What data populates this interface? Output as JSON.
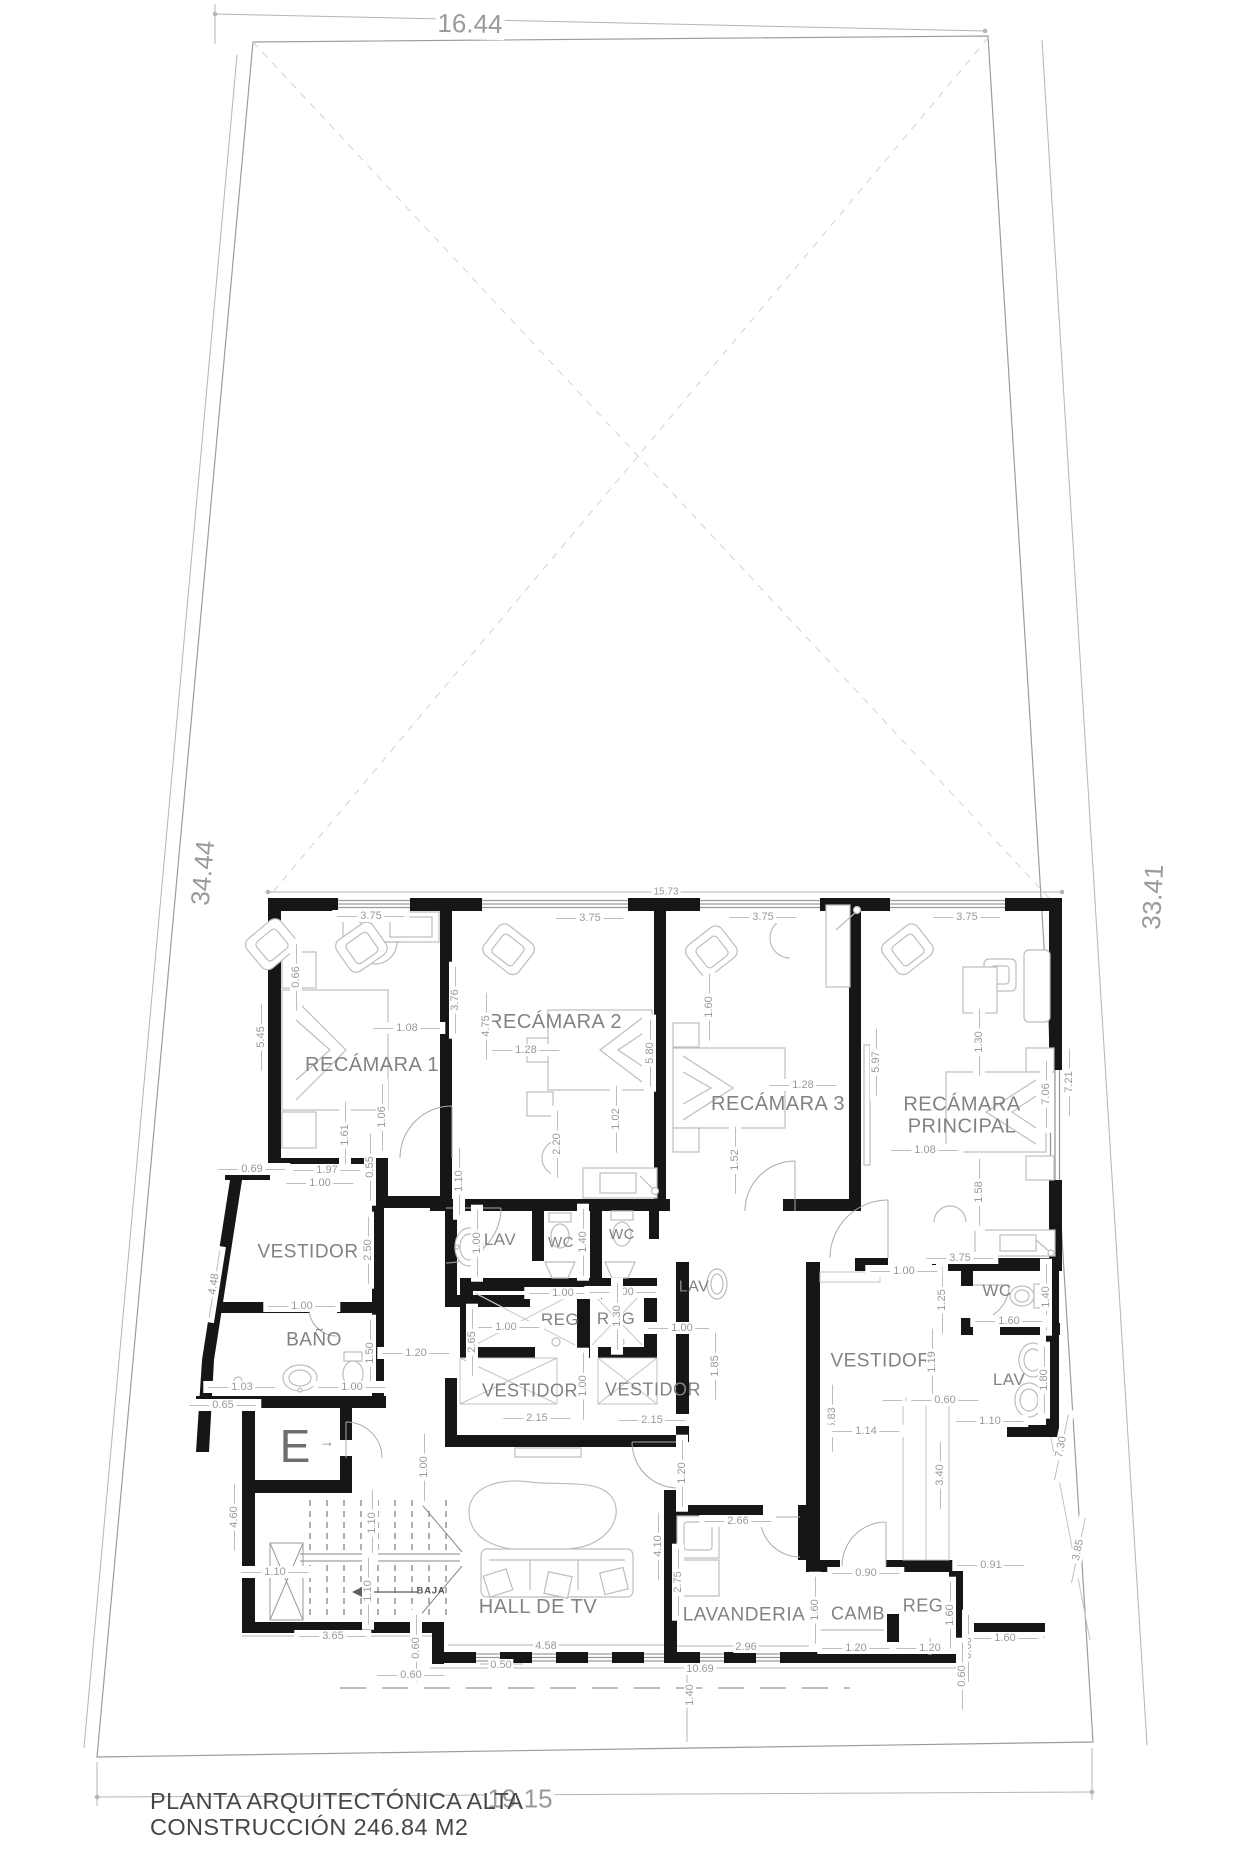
{
  "plan": {
    "title_line1": "PLANTA ARQUITECTÓNICA ALTA",
    "title_line2": "CONSTRUCCIÓN 246.84 M2",
    "elevator_label": "E",
    "elevator_arrow": "→",
    "stairs_direction": "BAJA",
    "site_dimensions": {
      "top": "16.44",
      "left": "34.44",
      "right": "33.41",
      "bottom": "19.15"
    },
    "rooms": [
      {
        "label": "RECÁMARA 1",
        "x": 372,
        "y": 1066,
        "fs": 20
      },
      {
        "label": "RECÁMARA 2",
        "x": 555,
        "y": 1023,
        "fs": 20
      },
      {
        "label": "RECÁMARA 3",
        "x": 778,
        "y": 1105,
        "fs": 20
      },
      {
        "label": "RECÁMARA PRINCIPAL",
        "x": 962,
        "y": 1116,
        "fs": 20,
        "w": 175
      },
      {
        "label": "VESTIDOR",
        "x": 308,
        "y": 1253,
        "fs": 19
      },
      {
        "label": "BAÑO",
        "x": 314,
        "y": 1341,
        "fs": 19
      },
      {
        "label": "LAV",
        "x": 500,
        "y": 1240,
        "fs": 17
      },
      {
        "label": "WC",
        "x": 561,
        "y": 1243,
        "fs": 15
      },
      {
        "label": "WC",
        "x": 622,
        "y": 1235,
        "fs": 15
      },
      {
        "label": "REG",
        "x": 560,
        "y": 1320,
        "fs": 17
      },
      {
        "label": "REG",
        "x": 616,
        "y": 1319,
        "fs": 17
      },
      {
        "label": "VESTIDOR",
        "x": 530,
        "y": 1391,
        "fs": 18
      },
      {
        "label": "VESTIDOR",
        "x": 653,
        "y": 1390,
        "fs": 18
      },
      {
        "label": "LAV",
        "x": 694,
        "y": 1287,
        "fs": 16
      },
      {
        "label": "VESTIDOR",
        "x": 881,
        "y": 1362,
        "fs": 19
      },
      {
        "label": "WC",
        "x": 997,
        "y": 1291,
        "fs": 17
      },
      {
        "label": "LAV",
        "x": 1009,
        "y": 1380,
        "fs": 17
      },
      {
        "label": "HALL DE TV",
        "x": 538,
        "y": 1608,
        "fs": 20
      },
      {
        "label": "LAVANDERIA",
        "x": 744,
        "y": 1616,
        "fs": 19
      },
      {
        "label": "CAMB",
        "x": 858,
        "y": 1614,
        "fs": 18
      },
      {
        "label": "REG",
        "x": 923,
        "y": 1606,
        "fs": 18
      }
    ],
    "dims": [
      {
        "t": "16.44",
        "x": 470,
        "y": 24,
        "r": 1,
        "fs": 26,
        "nd": 1
      },
      {
        "t": "34.44",
        "x": 203,
        "y": 873,
        "r": -85,
        "fs": 26,
        "nd": 1
      },
      {
        "t": "33.41",
        "x": 1153,
        "y": 897,
        "r": -87,
        "fs": 26,
        "nd": 1
      },
      {
        "t": "19.15",
        "x": 520,
        "y": 1799,
        "r": 0,
        "fs": 26,
        "nd": 1
      },
      {
        "t": "15.73",
        "x": 666,
        "y": 892,
        "r": 0,
        "fs": 10,
        "nd": 1
      },
      {
        "t": "3.75",
        "x": 371,
        "y": 916,
        "r": 0
      },
      {
        "t": "3.75",
        "x": 590,
        "y": 918,
        "r": 0
      },
      {
        "t": "3.75",
        "x": 763,
        "y": 917,
        "r": 0
      },
      {
        "t": "3.75",
        "x": 967,
        "y": 917,
        "r": 0
      },
      {
        "t": "5.45",
        "x": 261,
        "y": 1037,
        "r": -90
      },
      {
        "t": "0.66",
        "x": 296,
        "y": 977,
        "r": -90
      },
      {
        "t": "1.08",
        "x": 407,
        "y": 1028,
        "r": 0
      },
      {
        "t": "3.76",
        "x": 455,
        "y": 1000,
        "r": -90
      },
      {
        "t": "4.75",
        "x": 486,
        "y": 1026,
        "r": -90
      },
      {
        "t": "1.61",
        "x": 345,
        "y": 1135,
        "r": -90
      },
      {
        "t": "1.06",
        "x": 382,
        "y": 1117,
        "r": -90
      },
      {
        "t": "1.28",
        "x": 526,
        "y": 1050,
        "r": 0
      },
      {
        "t": "5.80",
        "x": 650,
        "y": 1053,
        "r": -90
      },
      {
        "t": "1.02",
        "x": 616,
        "y": 1119,
        "r": -90
      },
      {
        "t": "2.20",
        "x": 557,
        "y": 1144,
        "r": -90
      },
      {
        "t": "1.60",
        "x": 709,
        "y": 1007,
        "r": -90
      },
      {
        "t": "1.28",
        "x": 803,
        "y": 1085,
        "r": 0
      },
      {
        "t": "5.97",
        "x": 876,
        "y": 1062,
        "r": -90
      },
      {
        "t": "1.52",
        "x": 735,
        "y": 1160,
        "r": -90
      },
      {
        "t": "1.30",
        "x": 979,
        "y": 1042,
        "r": -90
      },
      {
        "t": "1.08",
        "x": 925,
        "y": 1150,
        "r": 0
      },
      {
        "t": "7.06",
        "x": 1046,
        "y": 1094,
        "r": -90
      },
      {
        "t": "7.21",
        "x": 1069,
        "y": 1082,
        "r": -90
      },
      {
        "t": "1.58",
        "x": 979,
        "y": 1192,
        "r": -90
      },
      {
        "t": "0.69",
        "x": 252,
        "y": 1169,
        "r": 0
      },
      {
        "t": "1.97",
        "x": 327,
        "y": 1170,
        "r": 0
      },
      {
        "t": "1.00",
        "x": 320,
        "y": 1183,
        "r": 0
      },
      {
        "t": "0.55",
        "x": 370,
        "y": 1167,
        "r": -90
      },
      {
        "t": "2.50",
        "x": 368,
        "y": 1250,
        "r": -90
      },
      {
        "t": "4.48",
        "x": 214,
        "y": 1284,
        "r": -81
      },
      {
        "t": "1.00",
        "x": 302,
        "y": 1306,
        "r": 0
      },
      {
        "t": "1.50",
        "x": 370,
        "y": 1353,
        "r": -90
      },
      {
        "t": "1.03",
        "x": 242,
        "y": 1387,
        "r": 0
      },
      {
        "t": "1.00",
        "x": 352,
        "y": 1387,
        "r": 0
      },
      {
        "t": "0.65",
        "x": 223,
        "y": 1405,
        "r": 0
      },
      {
        "t": "1.20",
        "x": 416,
        "y": 1353,
        "r": 0
      },
      {
        "t": "4.60",
        "x": 234,
        "y": 1517,
        "r": -90
      },
      {
        "t": "1.10",
        "x": 372,
        "y": 1523,
        "r": -90
      },
      {
        "t": "1.10",
        "x": 275,
        "y": 1572,
        "r": 0
      },
      {
        "t": "1.10",
        "x": 368,
        "y": 1591,
        "r": -90
      },
      {
        "t": "1.00",
        "x": 424,
        "y": 1467,
        "r": -90
      },
      {
        "t": "3.65",
        "x": 333,
        "y": 1636,
        "r": 0
      },
      {
        "t": "0.60",
        "x": 416,
        "y": 1648,
        "r": -90
      },
      {
        "t": "0.60",
        "x": 411,
        "y": 1675,
        "r": 0
      },
      {
        "t": "1.10",
        "x": 459,
        "y": 1181,
        "r": -90
      },
      {
        "t": "1.00",
        "x": 477,
        "y": 1243,
        "r": -90
      },
      {
        "t": "1.40",
        "x": 583,
        "y": 1242,
        "r": -90
      },
      {
        "t": "1.00",
        "x": 563,
        "y": 1293,
        "r": 0
      },
      {
        "t": "1.00",
        "x": 623,
        "y": 1292,
        "r": 0
      },
      {
        "t": "1.30",
        "x": 617,
        "y": 1316,
        "r": -90
      },
      {
        "t": "1.00",
        "x": 506,
        "y": 1327,
        "r": 0
      },
      {
        "t": "1.00",
        "x": 682,
        "y": 1328,
        "r": 0
      },
      {
        "t": "2.65",
        "x": 472,
        "y": 1342,
        "r": -90
      },
      {
        "t": "1.00",
        "x": 583,
        "y": 1386,
        "r": -90
      },
      {
        "t": "2.15",
        "x": 537,
        "y": 1418,
        "r": 0
      },
      {
        "t": "2.15",
        "x": 652,
        "y": 1420,
        "r": 0
      },
      {
        "t": "1.85",
        "x": 715,
        "y": 1366,
        "r": -90
      },
      {
        "t": "1.20",
        "x": 682,
        "y": 1473,
        "r": -90
      },
      {
        "t": "4.10",
        "x": 658,
        "y": 1546,
        "r": -90
      },
      {
        "t": "2.75",
        "x": 678,
        "y": 1582,
        "r": -90
      },
      {
        "t": "4.58",
        "x": 546,
        "y": 1646,
        "r": 0,
        "nd": 1
      },
      {
        "t": "0.50",
        "x": 501,
        "y": 1665,
        "r": 0,
        "nd": 1
      },
      {
        "t": "10.69",
        "x": 700,
        "y": 1669,
        "r": 0,
        "nd": 1
      },
      {
        "t": "1.40",
        "x": 690,
        "y": 1695,
        "r": -90,
        "nd": 1
      },
      {
        "t": "2.96",
        "x": 746,
        "y": 1647,
        "r": 0,
        "nd": 1
      },
      {
        "t": "2.66",
        "x": 738,
        "y": 1521,
        "r": 0
      },
      {
        "t": "1.60",
        "x": 815,
        "y": 1610,
        "r": -90
      },
      {
        "t": "0.90",
        "x": 866,
        "y": 1573,
        "r": 0
      },
      {
        "t": "1.20",
        "x": 856,
        "y": 1648,
        "r": 0
      },
      {
        "t": "1.20",
        "x": 930,
        "y": 1648,
        "r": 0
      },
      {
        "t": "1.60",
        "x": 950,
        "y": 1615,
        "r": -90
      },
      {
        "t": "0.91",
        "x": 991,
        "y": 1565,
        "r": 0
      },
      {
        "t": "1.60",
        "x": 1005,
        "y": 1638,
        "r": 0
      },
      {
        "t": "0.60",
        "x": 968,
        "y": 1648,
        "r": -90
      },
      {
        "t": "0.60",
        "x": 962,
        "y": 1676,
        "r": -90
      },
      {
        "t": "5.83",
        "x": 832,
        "y": 1418,
        "r": -90
      },
      {
        "t": "1.14",
        "x": 866,
        "y": 1431,
        "r": 0
      },
      {
        "t": "1.19",
        "x": 932,
        "y": 1362,
        "r": -90
      },
      {
        "t": "1.25",
        "x": 942,
        "y": 1300,
        "r": -90
      },
      {
        "t": "0.60",
        "x": 916,
        "y": 1400,
        "r": 0
      },
      {
        "t": "0.60",
        "x": 945,
        "y": 1400,
        "r": 0
      },
      {
        "t": "1.10",
        "x": 990,
        "y": 1421,
        "r": 0
      },
      {
        "t": "3.40",
        "x": 940,
        "y": 1475,
        "r": -90
      },
      {
        "t": "3.75",
        "x": 960,
        "y": 1258,
        "r": 0
      },
      {
        "t": "1.00",
        "x": 904,
        "y": 1271,
        "r": 0
      },
      {
        "t": "1.40",
        "x": 1046,
        "y": 1297,
        "r": -90
      },
      {
        "t": "1.60",
        "x": 1009,
        "y": 1321,
        "r": 0
      },
      {
        "t": "1.80",
        "x": 1044,
        "y": 1380,
        "r": -90
      },
      {
        "t": "7.30",
        "x": 1061,
        "y": 1447,
        "r": -78
      },
      {
        "t": "3.85",
        "x": 1078,
        "y": 1550,
        "r": -78
      }
    ]
  },
  "colors": {
    "wall": "#161616",
    "boundary": "#9c9c9c",
    "furniture": "#bdbdbd",
    "dim_text": "#9a9a9a",
    "room_text": "#828282",
    "title_text": "#474747"
  }
}
